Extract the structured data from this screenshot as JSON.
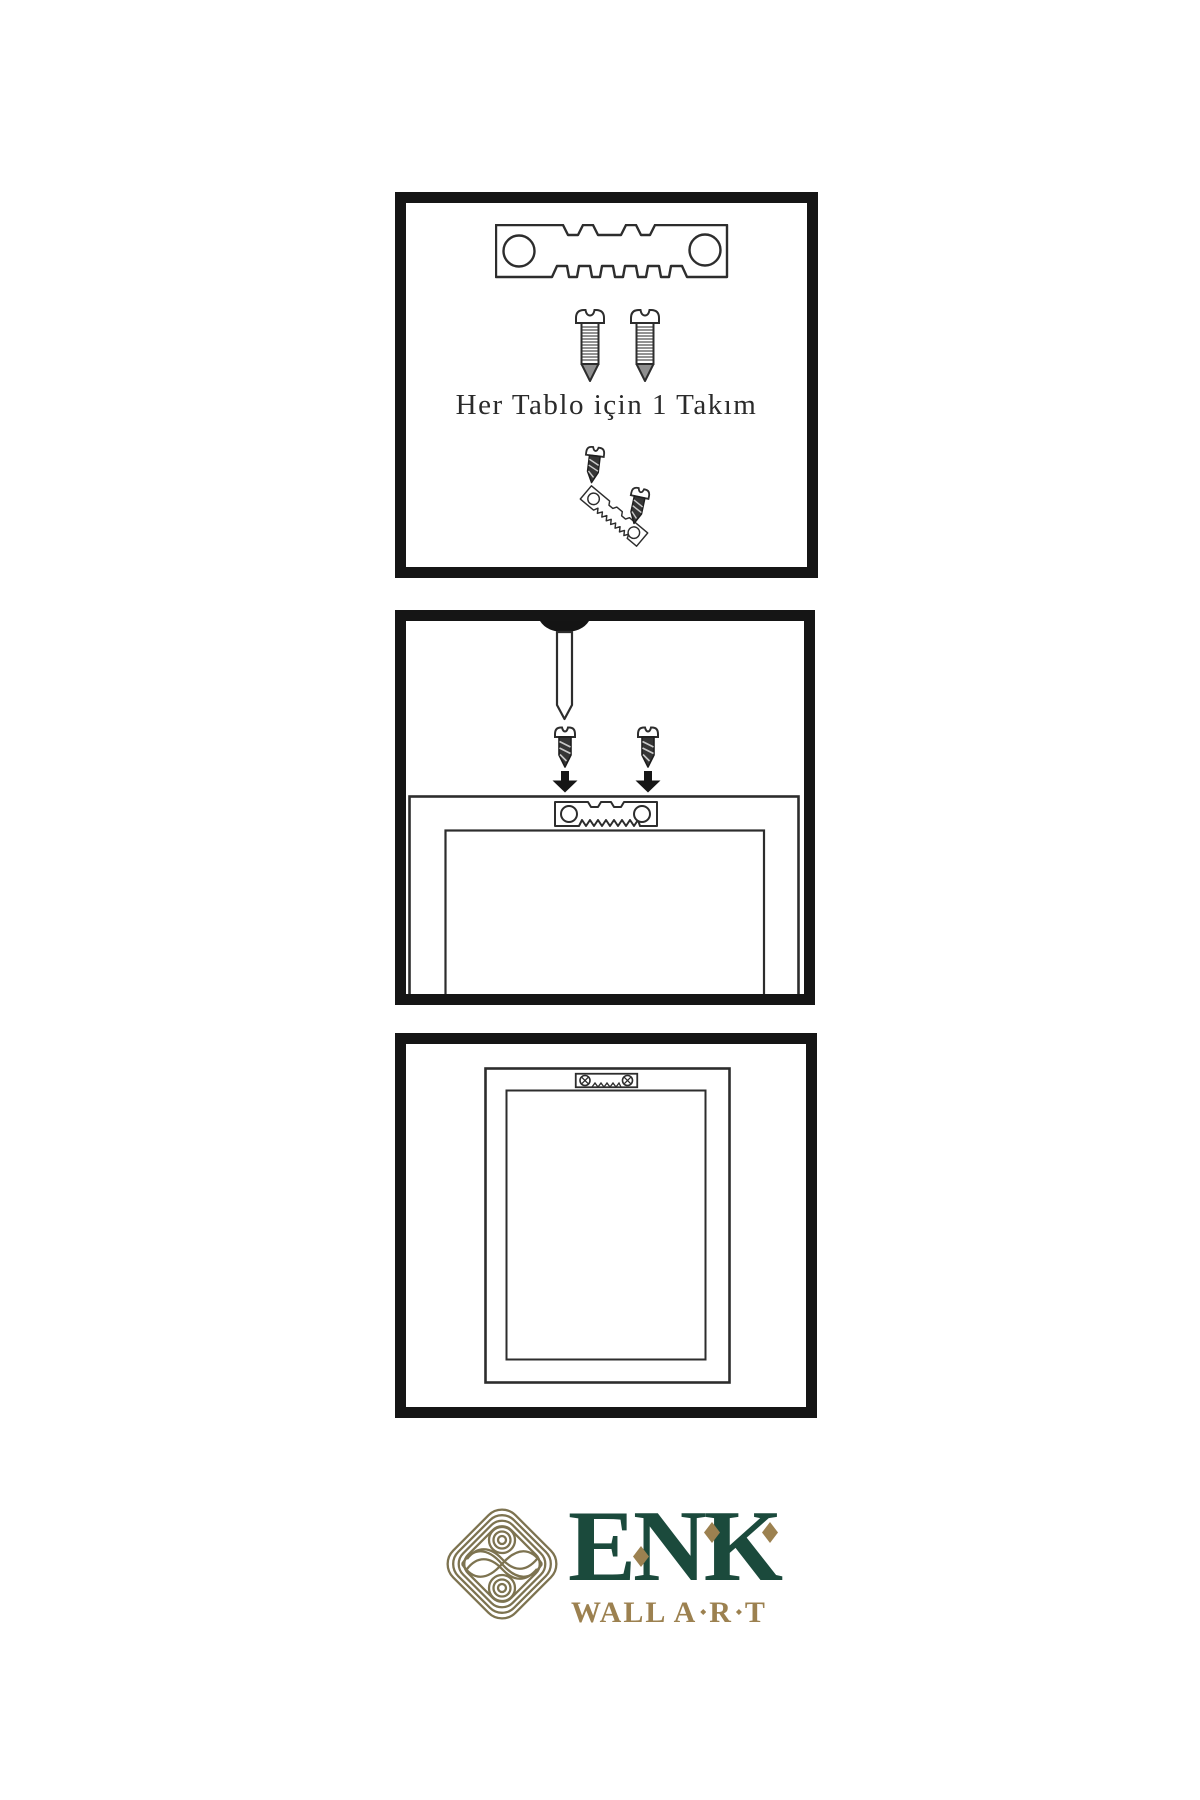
{
  "panels": {
    "step1": {
      "caption": "Her Tablo için 1 Takım",
      "illustrations": [
        "sawtooth-hanger-plate",
        "mounting-screw",
        "mounting-screw",
        "screw-driving-into-tilted-hanger"
      ]
    },
    "step2": {
      "illustrations": [
        "wall-nail",
        "mounting-screw-with-down-arrow",
        "mounting-screw-with-down-arrow",
        "frame-back-with-sawtooth-hanger-attached"
      ]
    },
    "step3": {
      "illustrations": [
        "frame-back-hung-with-sawtooth-hanger"
      ]
    }
  },
  "brand": {
    "name": "ENK",
    "tagline_word": "WALL",
    "tagline_letters": [
      "A",
      "R",
      "T"
    ],
    "logo": "interlaced-knot-emblem",
    "color_green": "#1b4a3c",
    "color_gold": "#9c8150",
    "color_knot": "#7d7350"
  },
  "colors": {
    "line": "#2d2d2d",
    "panel_border": "#151515",
    "background": "#ffffff"
  }
}
